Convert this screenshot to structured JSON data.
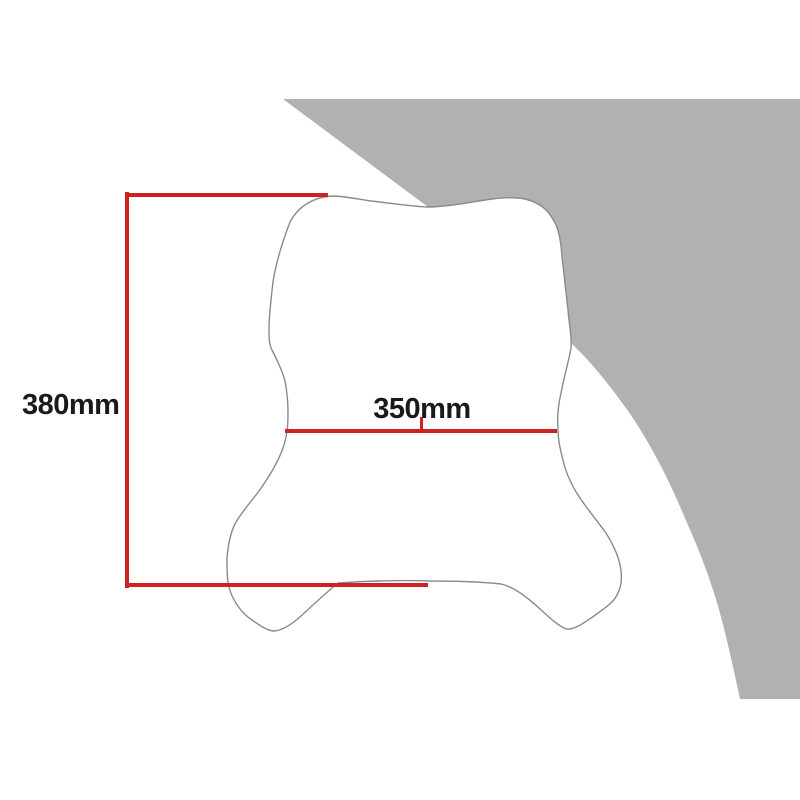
{
  "diagram": {
    "labels": {
      "height": "380mm",
      "width": "350mm"
    },
    "colors": {
      "background": "#ffffff",
      "swoosh": "#b1b1b1",
      "outline": "#8a8a8a",
      "windscreen_fill": "#ffffff",
      "dimension_line": "#cc2222",
      "text": "#1a1a1a"
    }
  }
}
